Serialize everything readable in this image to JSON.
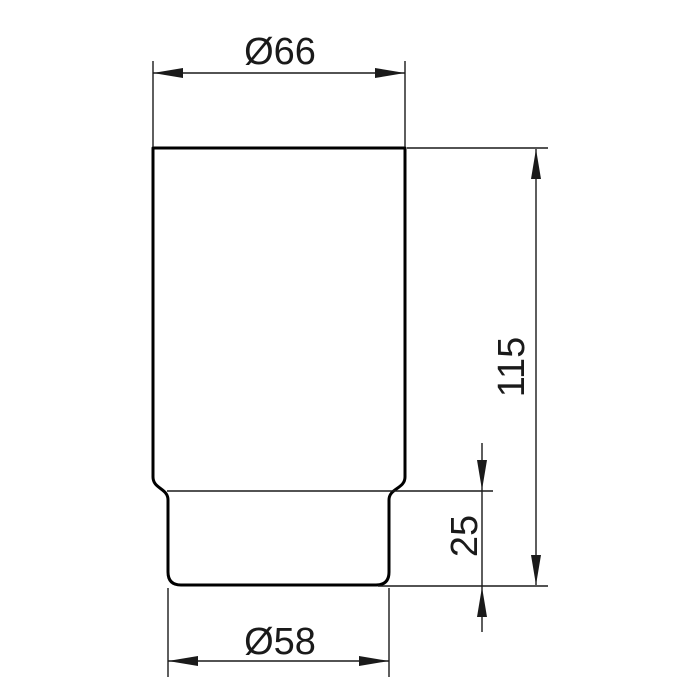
{
  "drawing": {
    "background": "#ffffff",
    "line_color": "#1a1a1a",
    "outline_color": "#000000",
    "dimensions": {
      "top_diameter": {
        "label": "Ø66",
        "value": 66,
        "unit": "mm"
      },
      "total_height": {
        "label": "115",
        "value": 115,
        "unit": "mm"
      },
      "base_height": {
        "label": "25",
        "value": 25,
        "unit": "mm"
      },
      "base_diameter": {
        "label": "Ø58",
        "value": 58,
        "unit": "mm"
      }
    }
  }
}
